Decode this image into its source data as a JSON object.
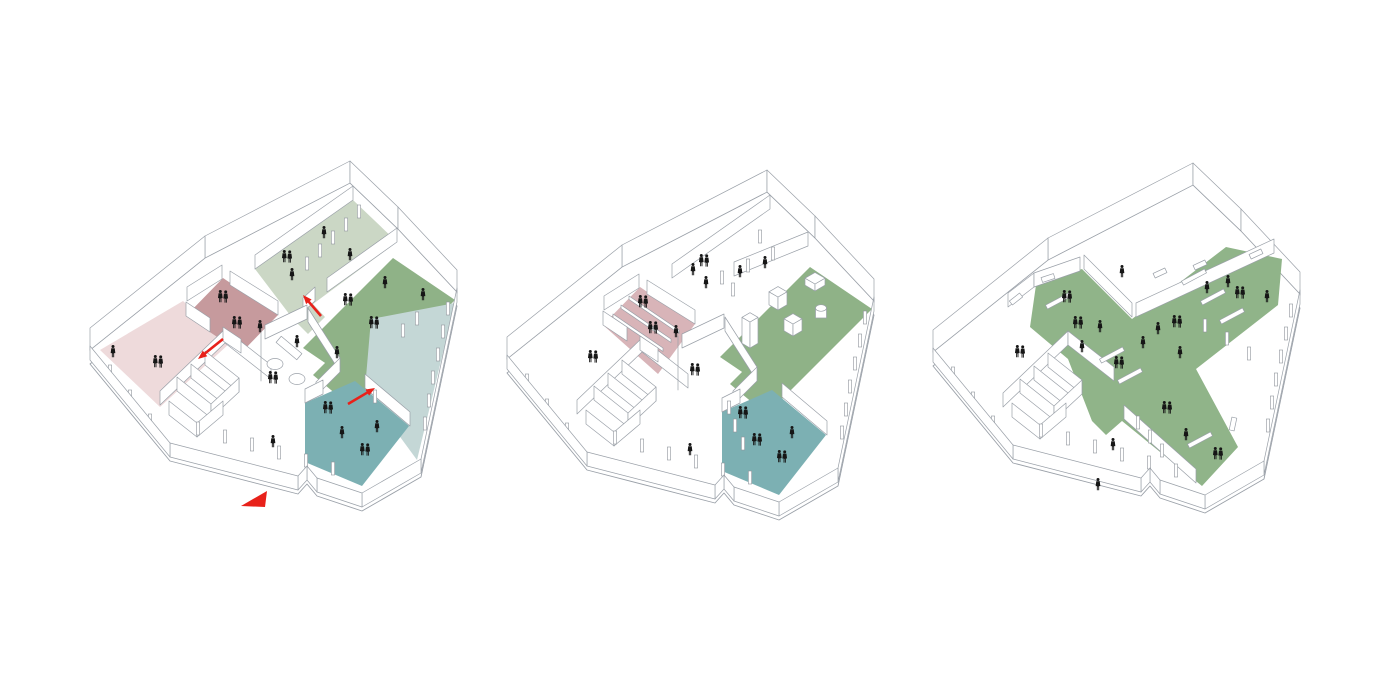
{
  "page": {
    "background": "#ffffff",
    "description": "Three axonometric architectural program diagrams of one irregular building plan"
  },
  "colors": {
    "line": "#9aa0a8",
    "figure": "#161616",
    "red": "#e8211a",
    "wall_fill": "#ffffff",
    "pale_green": "#cbd7c5",
    "medium_green": "#8fb287",
    "mauve": "#c69a9d",
    "mauve_light": "#d8b4b8",
    "pale_pink": "#eedadb",
    "teal": "#7cb0b3",
    "pale_blue": "#c4d7d6",
    "cross_green": "#90b489"
  },
  "base": {
    "perimeter": [
      [
        285,
        8
      ],
      [
        333,
        54
      ],
      [
        392,
        117
      ],
      [
        356,
        288
      ],
      [
        297,
        322
      ],
      [
        252,
        307
      ],
      [
        242,
        295
      ],
      [
        233,
        305
      ],
      [
        105,
        272
      ],
      [
        25,
        175
      ],
      [
        140,
        83
      ]
    ],
    "slab_drop": 14,
    "back_wall_height": 22,
    "interior_wall_height": 14,
    "back_walls": [
      [
        140,
        83,
        285,
        8
      ],
      [
        285,
        8,
        333,
        54
      ],
      [
        333,
        54,
        392,
        117
      ],
      [
        25,
        175,
        140,
        83
      ]
    ],
    "front_walls": [
      [
        392,
        117,
        356,
        288
      ],
      [
        356,
        288,
        297,
        322
      ],
      [
        297,
        322,
        252,
        307
      ],
      [
        252,
        307,
        242,
        295
      ],
      [
        242,
        295,
        233,
        305
      ],
      [
        233,
        305,
        105,
        272
      ],
      [
        105,
        272,
        25,
        175
      ]
    ],
    "cluster_walls": [
      [
        95,
        230,
        160,
        168
      ],
      [
        160,
        168,
        206,
        204
      ],
      [
        112,
        216,
        146,
        243
      ],
      [
        126,
        203,
        160,
        230
      ],
      [
        140,
        190,
        174,
        217
      ],
      [
        146,
        243,
        174,
        217
      ],
      [
        104,
        240,
        132,
        262
      ],
      [
        132,
        262,
        158,
        240
      ]
    ],
    "columns": [
      [
        383,
        140
      ],
      [
        378,
        163
      ],
      [
        373,
        186
      ],
      [
        368,
        209
      ],
      [
        364,
        232
      ],
      [
        360,
        255
      ],
      [
        268,
        300
      ],
      [
        241,
        292
      ],
      [
        214,
        284
      ],
      [
        187,
        276
      ],
      [
        160,
        268
      ],
      [
        133,
        260
      ],
      [
        85,
        252
      ],
      [
        65,
        228
      ],
      [
        45,
        203
      ]
    ]
  },
  "diagrams": [
    {
      "id": "axonometric-diagram-entry-level",
      "offset": [
        65,
        175
      ],
      "zones": [
        {
          "name": "pale-pink-room",
          "color": "#eedadb",
          "points": [
            [
              118,
              126
            ],
            [
              165,
              168
            ],
            [
              95,
              232
            ],
            [
              35,
              175
            ]
          ]
        },
        {
          "name": "mauve-room",
          "color": "#c69a9d",
          "points": [
            [
              158,
              103
            ],
            [
              213,
              140
            ],
            [
              176,
              178
            ],
            [
              121,
              141
            ]
          ]
        },
        {
          "name": "pale-green-room",
          "color": "#cbd7c5",
          "points": [
            [
              288,
              25
            ],
            [
              332,
              67
            ],
            [
              248,
              129
            ],
            [
              260,
              142
            ],
            [
              243,
              159
            ],
            [
              228,
              144
            ],
            [
              190,
              94
            ]
          ]
        },
        {
          "name": "medium-green-room",
          "color": "#8fb287",
          "points": [
            [
              328,
              83
            ],
            [
              390,
              125
            ],
            [
              300,
              215
            ],
            [
              238,
              173
            ]
          ]
        },
        {
          "name": "green-connector",
          "color": "#8fb287",
          "points": [
            [
              262,
              186
            ],
            [
              300,
              215
            ],
            [
              284,
              230
            ],
            [
              248,
              200
            ]
          ]
        },
        {
          "name": "pale-blue-room",
          "color": "#c4d7d6",
          "points": [
            [
              306,
              144
            ],
            [
              390,
              128
            ],
            [
              352,
              285
            ],
            [
              300,
              214
            ]
          ]
        },
        {
          "name": "teal-room",
          "color": "#7cb0b3",
          "points": [
            [
              240,
              228
            ],
            [
              290,
              206
            ],
            [
              344,
              251
            ],
            [
              297,
              311
            ],
            [
              240,
              287
            ]
          ]
        }
      ],
      "walls": [
        [
          288,
          25,
          190,
          94
        ],
        [
          332,
          67,
          262,
          117
        ],
        [
          250,
          126,
          238,
          137
        ],
        [
          122,
          126,
          157,
          104
        ],
        [
          165,
          110,
          213,
          140
        ],
        [
          121,
          141,
          145,
          157
        ],
        [
          158,
          166,
          176,
          178
        ],
        [
          200,
          164,
          242,
          144
        ],
        [
          243,
          147,
          275,
          197
        ],
        [
          275,
          197,
          251,
          221
        ],
        [
          196,
          166,
          196,
          206
        ],
        [
          240,
          228,
          258,
          219
        ],
        [
          300,
          213,
          345,
          251
        ]
      ],
      "columns": [
        [
          294,
          43
        ],
        [
          281,
          56
        ],
        [
          268,
          69
        ],
        [
          255,
          82
        ],
        [
          242,
          95
        ],
        [
          352,
          150
        ],
        [
          338,
          162
        ],
        [
          310,
          228
        ]
      ],
      "figures": [
        [
          "s",
          259,
          58
        ],
        [
          "p",
          222,
          82
        ],
        [
          "s",
          227,
          100
        ],
        [
          "s",
          285,
          80
        ],
        [
          "s",
          320,
          108
        ],
        [
          "p",
          283,
          125
        ],
        [
          "p",
          309,
          148
        ],
        [
          "s",
          272,
          178
        ],
        [
          "s",
          358,
          120
        ],
        [
          "p",
          158,
          122
        ],
        [
          "p",
          172,
          148
        ],
        [
          "s",
          195,
          152
        ],
        [
          "s",
          48,
          177
        ],
        [
          "p",
          93,
          187
        ],
        [
          "p",
          208,
          203
        ],
        [
          "s",
          232,
          167
        ],
        [
          "s",
          208,
          267
        ],
        [
          "p",
          263,
          233
        ],
        [
          "s",
          277,
          258
        ],
        [
          "p",
          300,
          275
        ],
        [
          "s",
          312,
          252
        ]
      ],
      "tables": [
        [
          210,
          189
        ],
        [
          232,
          204
        ]
      ],
      "bench": [
        224,
        173,
        40
      ],
      "stairs": [],
      "boxes": [],
      "cylinder": null,
      "benches": [],
      "windows": [],
      "arrows": [
        [
          256,
          141,
          238,
          120
        ],
        [
          158,
          164,
          133,
          184
        ],
        [
          283,
          229,
          310,
          213
        ]
      ],
      "entrance_triangle": [
        [
          176,
          331
        ],
        [
          202,
          316
        ],
        [
          200,
          332
        ]
      ]
    },
    {
      "id": "axonometric-diagram-program-level",
      "offset": [
        482,
        184
      ],
      "zones": [
        {
          "name": "mauve-stair-room",
          "color": "#d8b4b8",
          "points": [
            [
              158,
              103
            ],
            [
              213,
              140
            ],
            [
              176,
              190
            ],
            [
              121,
              141
            ]
          ]
        },
        {
          "name": "green-object-gallery",
          "color": "#8fb287",
          "points": [
            [
              328,
              83
            ],
            [
              390,
              125
            ],
            [
              300,
              215
            ],
            [
              238,
              173
            ]
          ]
        },
        {
          "name": "green-connector",
          "color": "#8fb287",
          "points": [
            [
              262,
              186
            ],
            [
              300,
              215
            ],
            [
              284,
              230
            ],
            [
              248,
              200
            ]
          ]
        },
        {
          "name": "teal-room",
          "color": "#7cb0b3",
          "points": [
            [
              240,
              228
            ],
            [
              290,
              206
            ],
            [
              344,
              251
            ],
            [
              297,
              311
            ],
            [
              240,
              287
            ]
          ]
        }
      ],
      "walls": [
        [
          288,
          25,
          190,
          94
        ],
        [
          252,
          92,
          326,
          62
        ],
        [
          122,
          126,
          157,
          104
        ],
        [
          165,
          110,
          213,
          140
        ],
        [
          121,
          141,
          145,
          157
        ],
        [
          158,
          166,
          176,
          178
        ],
        [
          200,
          164,
          242,
          144
        ],
        [
          243,
          147,
          275,
          197
        ],
        [
          275,
          197,
          251,
          221
        ],
        [
          196,
          166,
          196,
          206
        ],
        [
          240,
          228,
          258,
          219
        ],
        [
          300,
          213,
          345,
          251
        ]
      ],
      "columns": [
        [
          278,
          59
        ],
        [
          291,
          76
        ],
        [
          266,
          88
        ],
        [
          251,
          112
        ],
        [
          240,
          100
        ],
        [
          247,
          230
        ],
        [
          253,
          248
        ],
        [
          261,
          266
        ]
      ],
      "figures": [
        [
          "p",
          222,
          77
        ],
        [
          "s",
          211,
          86
        ],
        [
          "s",
          224,
          99
        ],
        [
          "s",
          258,
          88
        ],
        [
          "s",
          283,
          79
        ],
        [
          "p",
          161,
          118
        ],
        [
          "p",
          171,
          144
        ],
        [
          "s",
          194,
          148
        ],
        [
          "p",
          111,
          173
        ],
        [
          "p",
          213,
          186
        ],
        [
          "p",
          261,
          229
        ],
        [
          "p",
          275,
          256
        ],
        [
          "s",
          310,
          249
        ],
        [
          "p",
          300,
          273
        ],
        [
          "s",
          208,
          266
        ]
      ],
      "tables": [],
      "bench": null,
      "stairs": [
        [
          147,
          112
        ],
        [
          139,
          121
        ],
        [
          131,
          130
        ]
      ],
      "boxes": [
        [
          333,
          107,
          20,
          7
        ],
        [
          296,
          126,
          18,
          13
        ],
        [
          311,
          152,
          18,
          12
        ],
        [
          268,
          164,
          16,
          26
        ]
      ],
      "cylinder": [
        339,
        134,
        11,
        10
      ],
      "benches": [],
      "windows": [],
      "arrows": [],
      "entrance_triangle": null
    },
    {
      "id": "axonometric-diagram-circulation-cross",
      "offset": [
        908,
        177
      ],
      "zones": [
        {
          "name": "green-circulation-cross",
          "color": "#90b489",
          "points": [
            [
              128,
              108
            ],
            [
              174,
              92
            ],
            [
              224,
              142
            ],
            [
              318,
              70
            ],
            [
              374,
              82
            ],
            [
              370,
              128
            ],
            [
              288,
              192
            ],
            [
              330,
              270
            ],
            [
              294,
              309
            ],
            [
              214,
              244
            ],
            [
              198,
              258
            ],
            [
              184,
              244
            ],
            [
              160,
              182
            ],
            [
              122,
              150
            ]
          ]
        }
      ],
      "walls": [
        [
          100,
          130,
          126,
          110
        ],
        [
          126,
          110,
          172,
          94
        ],
        [
          176,
          92,
          224,
          140
        ],
        [
          228,
          140,
          366,
          76
        ],
        [
          216,
          242,
          288,
          306
        ]
      ],
      "columns": [
        [
          297,
          155
        ],
        [
          319,
          168
        ],
        [
          341,
          183
        ],
        [
          230,
          252
        ],
        [
          242,
          266
        ],
        [
          254,
          280
        ]
      ],
      "figures": [
        [
          "p",
          159,
          120
        ],
        [
          "p",
          170,
          146
        ],
        [
          "s",
          192,
          150
        ],
        [
          "s",
          174,
          170
        ],
        [
          "s",
          235,
          166
        ],
        [
          "p",
          211,
          186
        ],
        [
          "s",
          299,
          111
        ],
        [
          "s",
          320,
          105
        ],
        [
          "p",
          332,
          116
        ],
        [
          "s",
          359,
          120
        ],
        [
          "p",
          269,
          145
        ],
        [
          "s",
          250,
          152
        ],
        [
          "s",
          272,
          176
        ],
        [
          "p",
          259,
          231
        ],
        [
          "s",
          278,
          258
        ],
        [
          "p",
          310,
          277
        ],
        [
          "p",
          112,
          175
        ],
        [
          "s",
          214,
          95
        ],
        [
          "s",
          205,
          268
        ],
        [
          "s",
          190,
          308
        ]
      ],
      "tables": [],
      "bench": null,
      "stairs": [],
      "boxes": [],
      "cylinder": null,
      "benches": [
        [
          150,
          124,
          -28
        ],
        [
          204,
          178,
          -28
        ],
        [
          222,
          199,
          -28
        ],
        [
          305,
          120,
          -28
        ],
        [
          324,
          139,
          -28
        ],
        [
          292,
          263,
          -28
        ],
        [
          286,
          100,
          -28
        ]
      ],
      "windows": [
        [
          252,
          96,
          -25
        ],
        [
          292,
          88,
          -25
        ],
        [
          348,
          77,
          -25
        ],
        [
          140,
          101,
          -18
        ],
        [
          108,
          122,
          -38
        ],
        [
          325,
          247,
          -78
        ]
      ],
      "arrows": [],
      "entrance_triangle": null
    }
  ]
}
